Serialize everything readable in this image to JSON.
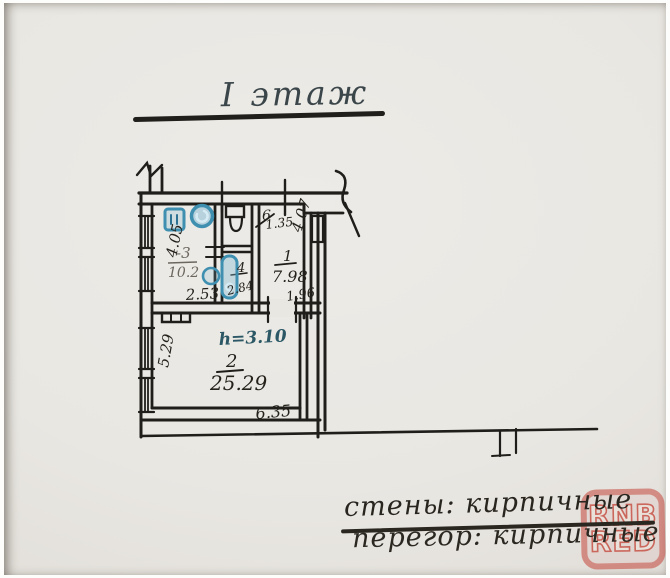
{
  "title": {
    "text": "I этаж"
  },
  "plan": {
    "height_note": "h=3.10",
    "rooms": {
      "r3": {
        "number": "-3",
        "area": "10.2"
      },
      "r6": {
        "number": "6",
        "area": "1.35"
      },
      "r4": {
        "number": "4",
        "area": "2.84"
      },
      "r1": {
        "number": "1",
        "area": "7.98"
      },
      "r2": {
        "number": "2",
        "area": "25.29"
      }
    },
    "dims": {
      "room3_width": "2.53",
      "room3_depth": "4.05",
      "room1_depth": "4.07",
      "room1_width": "1.96",
      "room2_depth": "5.29",
      "room2_width": "6.35"
    },
    "colors": {
      "ink": "#201e1a",
      "blue_marker": "#3e8fb0",
      "pencil": "#6b675f"
    }
  },
  "notes": {
    "line1": "стены: кирпичные",
    "line2": "перегор: кирпичные"
  },
  "watermark": {
    "line1": "RNB",
    "line2": "RED",
    "color": "#c1392c"
  }
}
